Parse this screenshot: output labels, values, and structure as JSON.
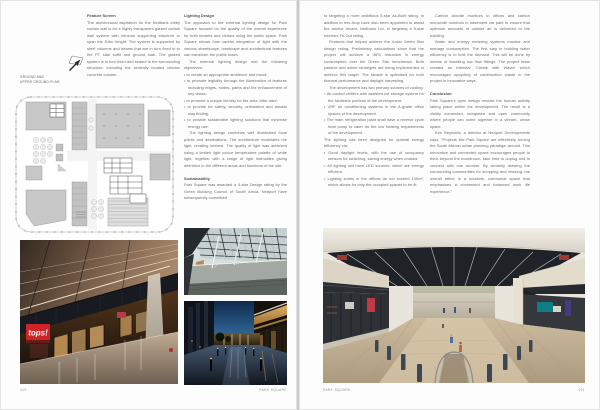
{
  "colors": {
    "paper": "#fdfdfd",
    "body_text": "#6a6a6a",
    "heading_text": "#4c4c4c",
    "tops_sign_red": "#d02328",
    "plan_block_gray": "#c7c7c7",
    "dusk_sky_blue": "#2f6392"
  },
  "left_page": {
    "page_number": "010",
    "footer_label": "PARK SQUARE",
    "plan": {
      "caption": "GROUND AND\nUPPER GROUND PLAN"
    },
    "feature_screen": {
      "heading": "Feature Screen",
      "body": "The architectural aspiration for the Nedbank lobby curtain wall is for a highly transparent glazed curtain wall system with minimal supporting structure to span the 8.6m height. The system is supported by steel columns and beams that are in turn fixed in to the PT slab soffit and ground slab. The glazed system is in turn fixed and sealed to the surrounding structure, including the centrally located circular concrete column."
    },
    "lighting": {
      "heading": "Lighting Design",
      "p1": "The approach to the external lighting design for Park Square focused on the quality of the overall experience for both tenants and visitors using the public space. Park Square shows how careful integration of light with the various streetscape, landscape and architectural features can transform the public realm.",
      "objectives_intro": "The external lighting design met the following objectives:",
      "bullets": [
        "to create an appropriate ambience and mood;",
        "to promote legibility through the illumination of features including edges, nodes, paths and the enhancement of key vistas;",
        "to promote a unique identity for the area 'after dark';",
        "to provide for safety, security, orientation and assists way finding;",
        "to provide sustainable lighting solutions that minimise energy use."
      ],
      "p3": "The lighting design combines well illuminated focal points and destinations. The architecture modulates the light, creating interest. The quality of light was achieved using a limited light colour temperature palette of white light, together with a range of light intensities giving definition to the different areas and functions of the site."
    },
    "sustainability": {
      "heading": "Sustainability",
      "body": "Park Square was awarded a 4-star Design rating by the Green Building Council of South Africa. Nedport have subsequently committed"
    },
    "photos": {
      "interior_sign_text": "tops!"
    }
  },
  "right_page": {
    "page_number": "011",
    "footer_label": "PARK SQUARE",
    "col1": {
      "p1": "to targeting a more ambitious 5-star As-Built rating. In addition to this Arup have also been appointed to assist the anchor tenant, Nedbank Ltd, in targeting a 5-star Interiors Fit-Out rating.",
      "p2": "Features that helped achieve the 4-star Green Star design rating: Preliminary calculations show that the project will achieve a 35% reduction in energy consumption over the Green Star benchmark. Both passive and active strategies are being implemented to achieve this target. The facade is optimised for both thermal performance and daylight harvesting.",
      "cooling_intro": "The development has two primary sources of cooling:",
      "cooling_bullets": [
        "Air-cooled chillers with assisted ice storage system for the Nedbank portions of the development.",
        "VRF air conditioning systems in the A-grade office spaces of the development.",
        "The main refrigeration plant shall have a reverse cycle heat pump to cater for the low heating requirements of the development."
      ],
      "lighting_intro": "The lighting has been designed for optimal energy efficiency via:",
      "lighting_bullets": [
        "Good daylight levels, with the use of occupancy sensors for switching, saving energy when unused.",
        "All lighting will have LED sources, which are energy efficient.",
        "Lighting zones in the offices do not exceed 100m², which allows for only the occupied spaces to be lit."
      ]
    },
    "col2": {
      "p1": "Carbon dioxide monitors in offices and carbon monoxide monitors in basement car park to ensure that optimum amounts of outside air is delivered to the building.",
      "p2": "Water and energy metering systems monitor and manage consumption. The first step in building water efficiency is to limit the demand. This will be done by means of installing low flow fittings. The project team created an initiative 'Create with Waste' which encourages upcycling of construction waste in the project in innovative ways.",
      "conclusion_heading": "Conclusion",
      "p3": "Park Square's open design reveals the human activity taking place within the development. The result is a visibly connected, integrated and open community where people can come together in a vibrant, urban space.",
      "p4": "Ken Reynolds, a director at Nedport Developments says, \"Projects like Park Square are effectively turning the South African urban planning paradigm around. This innovative and connected space encourages people to think beyond the boardroom, take time to unplug and to connect with one another. By similarly drawing the surrounding communities for shopping and relaxing, the overall effect is a sociable, communal space that emphasises a convenient and balanced work life experience.\""
    }
  }
}
